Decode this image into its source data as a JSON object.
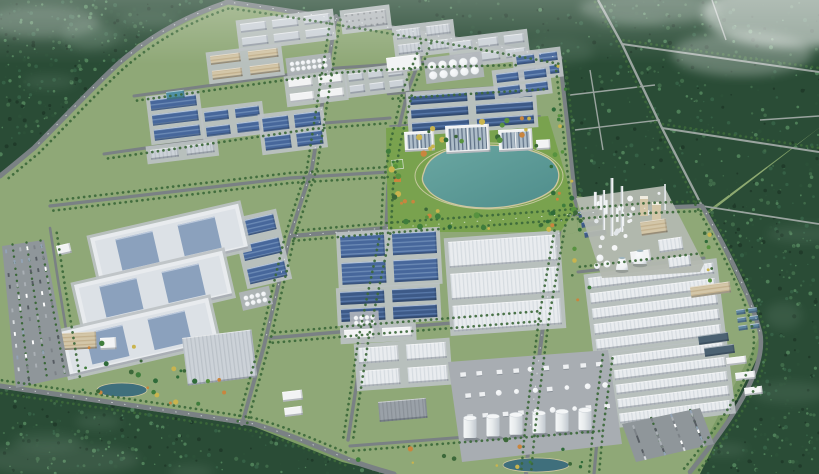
{
  "scene": {
    "name": "industrial-park-aerial-rendering",
    "type": "3d-architectural-rendering",
    "view": "oblique-aerial",
    "setting": "large industrial park with factories, warehouses, a central lake park and a chemical plant, surrounded by dense forest and farmland crossed by rural roads"
  },
  "palette": {
    "field_green": "#7d9c66",
    "field_light": "#8fab72",
    "forest_dark": "#2a4c36",
    "forest_deep": "#203b2a",
    "forest_light": "#3f6a49",
    "forest_mist": "#7c9a86",
    "park_green": "#8fa877",
    "lawn_green": "#79a24e",
    "road_main": "#7a8184",
    "road_minor": "#8e9699",
    "road_rural": "#9aa49f",
    "roof_blue": "#47679b",
    "roof_blue_light": "#6b8ab5",
    "roof_navy": "#3d5a88",
    "roof_navy_light": "#5878a8",
    "roof_white": "#e9ecef",
    "roof_gray": "#ccd2d8",
    "roof_dark_gray": "#9aa1a8",
    "wall_tan": "#d3c6a8",
    "wall_white": "#f2f3f4",
    "skylight_blue": "#8ba1bd",
    "glass_dark": "#5f7186",
    "water_lake": "#4f8d8b",
    "water_lake_light": "#6aa7a2",
    "water_pond": "#3f6f7c",
    "water_basin": "#4c6272",
    "water_pool": "#5f86a0",
    "water_feature": "#4f90a5",
    "tank_white": "#eef0f2",
    "concrete": "#bdc2c4",
    "asphalt": "#8f969a",
    "tree_green": "#3c6839",
    "tree_orange": "#c9853e",
    "tree_yellow": "#c9b44e",
    "shore_sand": "#cfc7a0",
    "haze_white": "#ffffff"
  },
  "features": [
    {
      "id": "forest-regions",
      "label": "surrounding forest"
    },
    {
      "id": "field-patches",
      "label": "farmland patches"
    },
    {
      "id": "rural-roads",
      "label": "rural road network"
    },
    {
      "id": "main-roads",
      "label": "tree-lined park ring road and internal grid"
    },
    {
      "id": "factory-district-north",
      "label": "northern factory district with blue and gray roofed plants"
    },
    {
      "id": "storage-silos",
      "label": "white storage silo groups"
    },
    {
      "id": "logistics-warehouses-west",
      "label": "three large west logistics warehouses with skylights"
    },
    {
      "id": "production-halls-center",
      "label": "central blue ribbed production halls"
    },
    {
      "id": "warehouse-rows-center",
      "label": "central white ribbed warehouses"
    },
    {
      "id": "lake-park",
      "label": "central landscaped park with teal lake"
    },
    {
      "id": "campus-buildings",
      "label": "glass-roofed campus offices above the lake"
    },
    {
      "id": "chemical-plant",
      "label": "eastern chemical plant with stacks and cooling towers"
    },
    {
      "id": "tank-farm",
      "label": "southern processing plant and cylindrical tank row"
    },
    {
      "id": "warehouse-district-southeast",
      "label": "southeast long warehouse rows"
    },
    {
      "id": "water-treatment",
      "label": "water treatment basins and pools"
    },
    {
      "id": "parking-lot-west",
      "label": "west parking lot with cars"
    },
    {
      "id": "parking-lot-southeast",
      "label": "southeast parking lot"
    },
    {
      "id": "office-buildings-southwest",
      "label": "southwest office buildings and pond"
    },
    {
      "id": "haze-overlay",
      "label": "atmospheric haze in top corners"
    }
  ]
}
